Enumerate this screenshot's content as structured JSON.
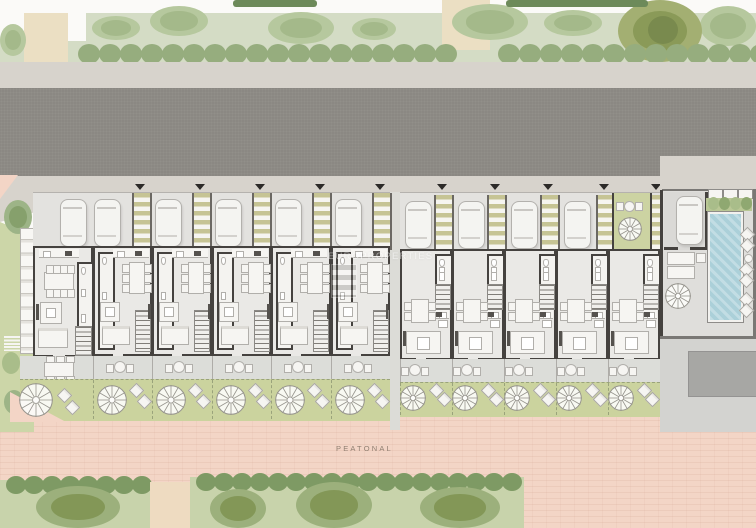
{
  "labels": {
    "street": "PEATONAL"
  },
  "watermark": {
    "text": "EUROPROPERTIES"
  },
  "colors": {
    "page_bg": "#fbfaf8",
    "landscape_green": "#d4dcc5",
    "hedge_green": "#8ba674",
    "hedge_dark": "#6d8a5a",
    "bush_green": "#b6c89e",
    "tree_olive_outer": "#a3af72",
    "tree_olive_inner": "#8a9a58",
    "sand": "#ebdfc3",
    "sidewalk": "#d7d3cc",
    "road": "#8b8883",
    "pink_paving": "#f3d5c6",
    "driveway": "#e3e2df",
    "pergola_stripe": "#c6c494",
    "wall": "#45423f",
    "floor": "#eae9e6",
    "furniture_line": "#b1afab",
    "furniture_fill": "#f6f5f2",
    "terrace": "#dcddd9",
    "garden": "#cbd39e",
    "garden_fence": "#9aa37b",
    "pool_water": "#abd0d9",
    "deck": "#d8d7d4",
    "courtyard": "#dfdedb",
    "dark_pad": "#a7a7a4",
    "label": "#8f7e70"
  },
  "site": {
    "units": [
      {
        "id": "unit-1",
        "variant": "corner",
        "x": 33,
        "w": 60
      },
      {
        "id": "unit-2",
        "variant": "A",
        "x": 93,
        "w": 59.4
      },
      {
        "id": "unit-3",
        "variant": "A",
        "x": 152.4,
        "w": 59.4
      },
      {
        "id": "unit-4",
        "variant": "A",
        "x": 211.8,
        "w": 59.4
      },
      {
        "id": "unit-5",
        "variant": "A",
        "x": 271.2,
        "w": 59.4
      },
      {
        "id": "unit-6",
        "variant": "A",
        "x": 330.6,
        "w": 59.4
      },
      {
        "id": "unit-7",
        "variant": "B",
        "x": 400,
        "w": 52
      },
      {
        "id": "unit-8",
        "variant": "B",
        "x": 452,
        "w": 52
      },
      {
        "id": "unit-9",
        "variant": "B",
        "x": 504,
        "w": 52
      },
      {
        "id": "unit-10",
        "variant": "B",
        "x": 556,
        "w": 52
      },
      {
        "id": "unit-11",
        "variant": "B",
        "x": 608,
        "w": 52
      }
    ],
    "pergola_strips_left": [
      132,
      192,
      252,
      312,
      372
    ],
    "pergola_strips_right": [
      434,
      487,
      540,
      596,
      648
    ],
    "cars_left": [
      60,
      94,
      155,
      215,
      275,
      335
    ],
    "cars_right": [
      405,
      458,
      511,
      564
    ],
    "pool_car": {
      "x": 676,
      "y": 196
    },
    "pool": {
      "x": 708,
      "y": 212,
      "w": 31,
      "h": 106
    },
    "green_terrace": {
      "x": 612,
      "y": 193,
      "w": 36,
      "h": 57
    }
  },
  "landscape": {
    "top_bushes": [
      {
        "x": 92,
        "y": 16,
        "w": 48,
        "h": 24
      },
      {
        "x": 150,
        "y": 6,
        "w": 58,
        "h": 30
      },
      {
        "x": 268,
        "y": 12,
        "w": 66,
        "h": 32
      },
      {
        "x": 352,
        "y": 18,
        "w": 44,
        "h": 22
      },
      {
        "x": 452,
        "y": 4,
        "w": 76,
        "h": 36
      },
      {
        "x": 544,
        "y": 10,
        "w": 58,
        "h": 26
      },
      {
        "x": 700,
        "y": 6,
        "w": 56,
        "h": 40
      },
      {
        "x": 0,
        "y": 24,
        "w": 26,
        "h": 32
      }
    ],
    "big_tree": {
      "x": 618,
      "y": 0,
      "w": 84,
      "h": 62
    },
    "top_hedge_bars": [
      {
        "x": 233,
        "w": 84
      },
      {
        "x": 506,
        "w": 142
      }
    ],
    "sand_paths": [
      {
        "x": 24,
        "y": 13,
        "w": 44,
        "h": 50
      },
      {
        "x": 442,
        "y": 0,
        "w": 48,
        "h": 50
      }
    ],
    "bottom_hedges": [
      {
        "x": 0,
        "y": 480,
        "w": 150,
        "h": 48
      },
      {
        "x": 190,
        "y": 477,
        "w": 334,
        "h": 51
      }
    ],
    "bottom_trees": [
      {
        "x": 36,
        "y": 486,
        "w": 84,
        "h": 42
      },
      {
        "x": 210,
        "y": 489,
        "w": 56,
        "h": 39
      },
      {
        "x": 296,
        "y": 482,
        "w": 76,
        "h": 46
      },
      {
        "x": 420,
        "y": 487,
        "w": 80,
        "h": 41
      }
    ],
    "bottom_sand_gap": {
      "x": 150,
      "y": 482,
      "w": 40,
      "h": 46
    }
  }
}
